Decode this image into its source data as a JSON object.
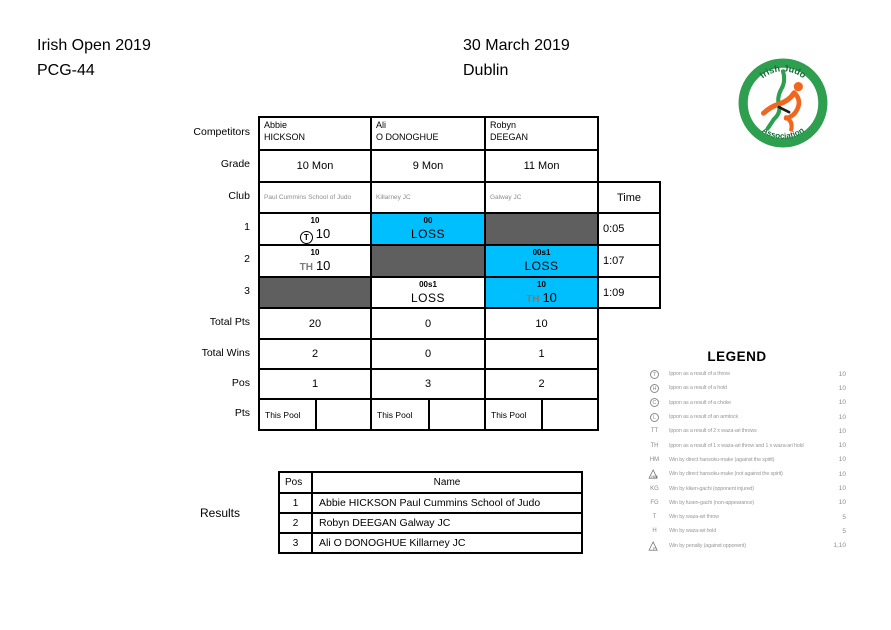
{
  "page": {
    "event": "Irish Open 2019",
    "code": "PCG-44",
    "date": "30 March 2019",
    "city": "Dublin"
  },
  "logo": {
    "arc_top": "Irish Judo",
    "arc_bottom": "Association"
  },
  "colors": {
    "highlight_cyan": "#00bfff",
    "blocked_gray": "#5f5f5f",
    "logo_green": "#2e9e4f",
    "logo_orange": "#f0661e",
    "muted_text": "#8c8c8c"
  },
  "pool": {
    "row_labels": {
      "competitors": "Competitors",
      "grade": "Grade",
      "club": "Club",
      "r1": "1",
      "r2": "2",
      "r3": "3",
      "total_pts": "Total Pts",
      "total_wins": "Total Wins",
      "pos": "Pos",
      "pts": "Pts"
    },
    "time_header": "Time",
    "competitors": [
      {
        "first": "Abbie",
        "last": "HICKSON",
        "grade": "10 Mon",
        "club": "Paul Cummins School of Judo",
        "total_pts": "20",
        "total_wins": "2",
        "pos": "1",
        "pts_pool_label": "This Pool"
      },
      {
        "first": "Ali",
        "last": "O DONOGHUE",
        "grade": "9 Mon",
        "club": "Killarney JC",
        "total_pts": "0",
        "total_wins": "0",
        "pos": "3",
        "pts_pool_label": "This Pool"
      },
      {
        "first": "Robyn",
        "last": "DEEGAN",
        "grade": "11 Mon",
        "club": "Galway JC",
        "total_pts": "10",
        "total_wins": "1",
        "pos": "2",
        "pts_pool_label": "This Pool"
      }
    ],
    "matches": [
      {
        "time": "0:05",
        "cells": [
          {
            "bg": "white",
            "top": "10",
            "symbol": "T",
            "symbol_style": "circle",
            "main": "10"
          },
          {
            "bg": "cyan",
            "top": "00",
            "main": "LOSS"
          },
          {
            "bg": "gray"
          }
        ]
      },
      {
        "time": "1:07",
        "cells": [
          {
            "bg": "white",
            "top": "10",
            "symbol": "TH",
            "symbol_style": "text",
            "main": "10"
          },
          {
            "bg": "gray"
          },
          {
            "bg": "cyan",
            "top": "00s1",
            "main": "LOSS"
          }
        ]
      },
      {
        "time": "1:09",
        "cells": [
          {
            "bg": "gray"
          },
          {
            "bg": "white",
            "top": "00s1",
            "main": "LOSS"
          },
          {
            "bg": "cyan",
            "top": "10",
            "symbol": "TH",
            "symbol_style": "text",
            "main": "10"
          }
        ]
      }
    ]
  },
  "legend": {
    "title": "LEGEND",
    "items": [
      {
        "sym": "T",
        "style": "circle",
        "desc": "Ippon as a result of a throw",
        "value": "10"
      },
      {
        "sym": "H",
        "style": "circle",
        "desc": "Ippon as a result of a hold",
        "value": "10"
      },
      {
        "sym": "C",
        "style": "circle",
        "desc": "Ippon as a result of a choke",
        "value": "10"
      },
      {
        "sym": "L",
        "style": "circle",
        "desc": "Ippon as a result of an armlock",
        "value": "10"
      },
      {
        "sym": "TT",
        "style": "text",
        "desc": "Ippon as a result of 2 x waza-ari throws",
        "value": "10"
      },
      {
        "sym": "TH",
        "style": "text",
        "desc": "Ippon as a result of 1 x waza-ari throw and 1 x waza-ari hold",
        "value": "10"
      },
      {
        "sym": "HM",
        "style": "text",
        "desc": "Win by direct hansoku-make (against the spirit)",
        "value": "10"
      },
      {
        "sym": "HM",
        "style": "triangle",
        "desc": "Win by direct hansoku-make (not against the spirit)",
        "value": "10"
      },
      {
        "sym": "KG",
        "style": "text",
        "desc": "Win by kiken-gachi (opponent injured)",
        "value": "10"
      },
      {
        "sym": "FG",
        "style": "text",
        "desc": "Win by fusen-gachi (non-appearance)",
        "value": "10"
      },
      {
        "sym": "T",
        "style": "text",
        "desc": "Win by waza-ari throw",
        "value": "5"
      },
      {
        "sym": "H",
        "style": "text",
        "desc": "Win by waza-ari hold",
        "value": "5"
      },
      {
        "sym": "P",
        "style": "triangle",
        "desc": "Win by penalty (against opponent)",
        "value": "1,10"
      }
    ]
  },
  "results": {
    "label": "Results",
    "header": {
      "pos": "Pos",
      "name": "Name"
    },
    "rows": [
      {
        "pos": "1",
        "name": "Abbie HICKSON Paul Cummins School of Judo"
      },
      {
        "pos": "2",
        "name": "Robyn DEEGAN Galway JC"
      },
      {
        "pos": "3",
        "name": "Ali O DONOGHUE Killarney JC"
      }
    ]
  }
}
